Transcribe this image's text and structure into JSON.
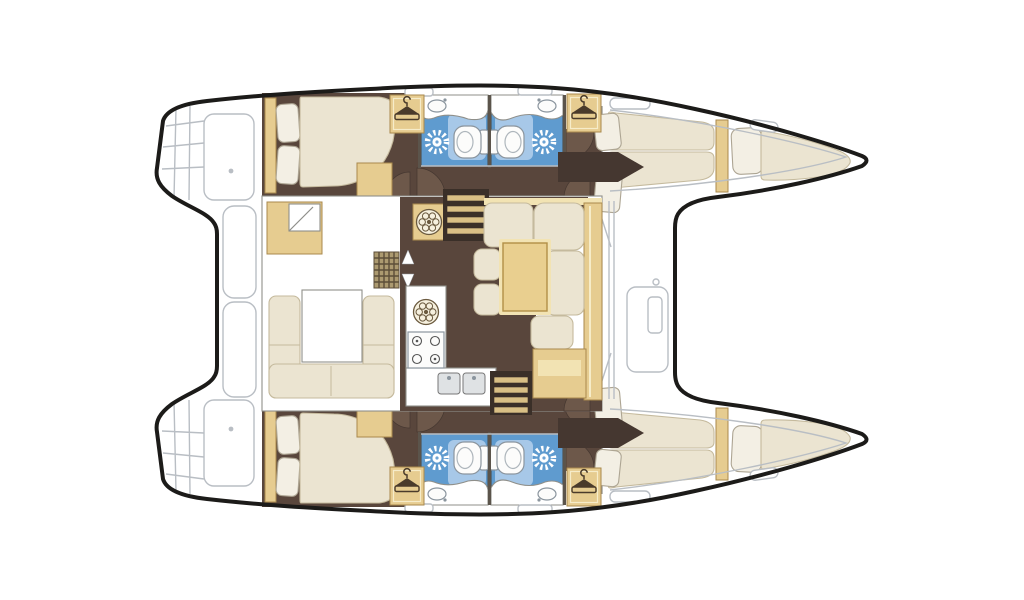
{
  "diagram": {
    "type": "catamaran-interior-floor-plan",
    "orientation": {
      "bow": "right",
      "stern": "left"
    },
    "hulls": [
      {
        "name": "port-hull",
        "position": "top",
        "rooms": [
          {
            "name": "transom-steps",
            "position": "stern"
          },
          {
            "name": "aft-cabin",
            "features": [
              "double-berth",
              "two-pillows",
              "headboard",
              "vanity-locker"
            ]
          },
          {
            "name": "aft-head",
            "features": [
              "shower-spray",
              "toilet",
              "washbasin-counter",
              "shower-tray"
            ]
          },
          {
            "name": "forward-head",
            "features": [
              "shower-spray",
              "toilet",
              "washbasin-counter",
              "shower-tray"
            ]
          },
          {
            "name": "hanging-lockers",
            "count": 2
          },
          {
            "name": "forward-cabin",
            "features": [
              "v-berth",
              "two-pillows",
              "access-aisle"
            ]
          },
          {
            "name": "bow-berth",
            "features": [
              "single-berth",
              "pillow",
              "bulkhead"
            ]
          }
        ]
      },
      {
        "name": "starboard-hull",
        "position": "bottom",
        "rooms": [
          {
            "name": "transom-steps",
            "position": "stern"
          },
          {
            "name": "aft-cabin",
            "features": [
              "double-berth",
              "two-pillows",
              "headboard",
              "vanity-locker"
            ]
          },
          {
            "name": "aft-head",
            "features": [
              "shower-spray",
              "toilet",
              "washbasin-counter",
              "shower-tray"
            ]
          },
          {
            "name": "forward-head",
            "features": [
              "shower-spray",
              "toilet",
              "washbasin-counter",
              "shower-tray"
            ]
          },
          {
            "name": "hanging-lockers",
            "count": 2
          },
          {
            "name": "forward-cabin",
            "features": [
              "v-berth",
              "two-pillows",
              "access-aisle"
            ]
          },
          {
            "name": "bow-berth",
            "features": [
              "single-berth",
              "pillow",
              "bulkhead"
            ]
          }
        ]
      }
    ],
    "bridge_deck": {
      "rooms": [
        {
          "name": "saloon",
          "features": [
            "nav-seat",
            "u-shaped-sofa",
            "sofa-table",
            "floor-grid-hatch",
            "fan-hatch",
            "direction-arrows"
          ]
        },
        {
          "name": "galley",
          "features": [
            "round-sink",
            "four-burner-stove",
            "double-sink",
            "l-shaped-counter"
          ]
        },
        {
          "name": "dinette",
          "features": [
            "l-shaped-sofa",
            "dining-table",
            "two-stools",
            "sideboard",
            "bench"
          ]
        },
        {
          "name": "companionway-stairs",
          "count": 2
        },
        {
          "name": "aft-cockpit",
          "features": [
            "bench-outlines"
          ]
        },
        {
          "name": "foredeck",
          "features": [
            "seat-locker-outline",
            "mast-beam-lines",
            "trampoline-void"
          ]
        }
      ]
    },
    "icons": [
      "shower-spray-icon",
      "coat-hanger-icon",
      "fan-hatch-icon",
      "burner-icon",
      "door-swing-arc"
    ]
  },
  "colors": {
    "inkOutline": "#1c1b19",
    "faintLine": "#b9bec4",
    "wallLine": "#8f8f8a",
    "floorBrown": "#59463c",
    "floorBrownDark": "#453730",
    "doorArc": "#6d584a",
    "creamFill": "#ebe4d1",
    "creamEdge": "#c5ba9d",
    "pillowFill": "#f3efe4",
    "pillowEdge": "#ada593",
    "tanFill": "#e6cc90",
    "tanEdge": "#a9894d",
    "tanLight": "#f2e3b3",
    "headsBlue": "#5f9bcf",
    "headsBlueLight": "#a7c8e8",
    "fixtureWhite": "#fcfcfb",
    "fixtureEdge": "#8b959e",
    "partitionGray": "#5b544b",
    "stairDark": "#3a2f28",
    "treadTan": "#d9bf85",
    "gridFill": "#ac9a70",
    "gridDot": "#5c4e39",
    "tableTan": "#e9cf8f",
    "tableEdge": "#b28f47",
    "hangerInk": "#4a3b2b"
  }
}
